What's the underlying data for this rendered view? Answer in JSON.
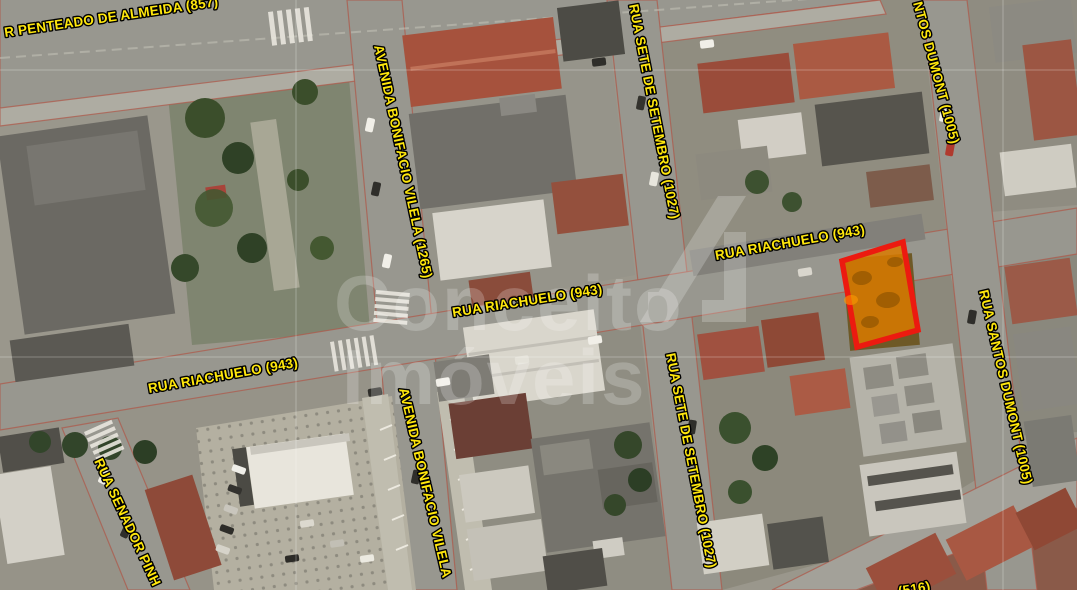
{
  "map": {
    "kind": "satellite-property-map",
    "watermark": {
      "line1": "Conceito",
      "line2": "Imóveis"
    },
    "street_labels": {
      "penteado": "R PENTEADO DE ALMEIDA (857)",
      "bonifacio_top": "AVENIDA BONIFACIO VILELA (1265)",
      "bonifacio_bottom": "AVENIDA BONIFACIO VILELA",
      "sete_setembro_top": "RUA SETE DE SETEMBRO (1027)",
      "sete_setembro_bottom": "RUA SETE DE SETEMBRO (1027)",
      "santos_dumont_top": "NTOS DUMONT (1005)",
      "santos_dumont_mid": "RUA SANTOS DUMONT (1005)",
      "riachuelo_left": "RUA RIACHUELO (943)",
      "riachuelo_center": "RUA RIACHUELO (943)",
      "riachuelo_right": "RUA RIACHUELO (943)",
      "senador": "RUA SENADOR PINH",
      "bottom_partial": "(516)"
    },
    "colors": {
      "label_fill": "#ffe70c",
      "label_outline": "#000000",
      "highlight_stroke": "#ec1a10",
      "highlight_fill": "#d97a00"
    }
  }
}
